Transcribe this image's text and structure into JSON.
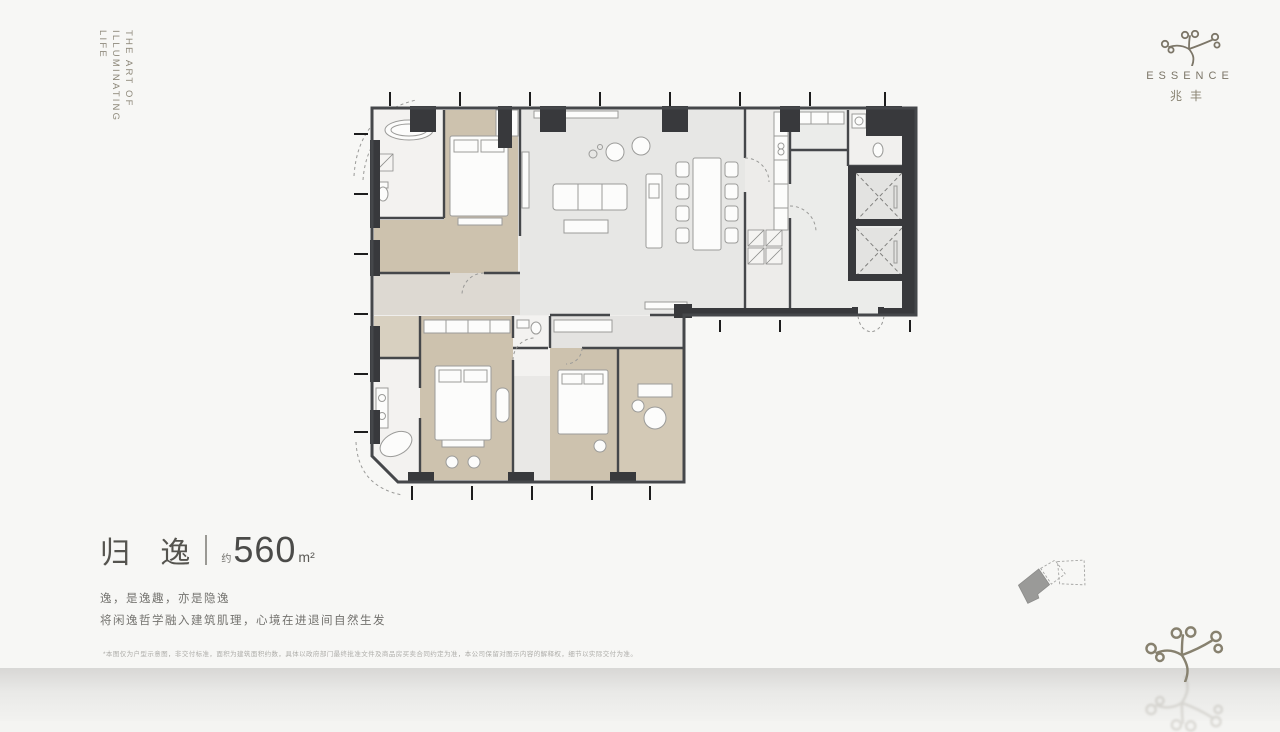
{
  "page": {
    "background": "#f4f4f2",
    "surface_band_top": "#d8d7d5"
  },
  "tagline": {
    "lines": [
      "THE ART OF",
      "ILLUMINATING",
      "LIFE"
    ]
  },
  "logo": {
    "wordmark": "ESSENCE",
    "cn": "兆丰",
    "icon": "branch-sprout-icon",
    "color": "#7c7668"
  },
  "floorplan": {
    "description": "L-shaped luxury apartment floor plan",
    "colors": {
      "wall": "#45474a",
      "column": "#38393c",
      "bedroom_floor": "#cdc2ae",
      "living_floor": "#e7e7e5",
      "bath_floor": "#f3f2f0"
    }
  },
  "title": {
    "name_cn": "归 逸",
    "approx": "约",
    "area_value": "560",
    "area_unit": "m²"
  },
  "copy": {
    "line1": "逸，是逸趣，亦是隐逸",
    "line2": "将闲逸哲学融入建筑肌理，心境在进退间自然生发"
  },
  "disclaimer": "*本图仅为户型示意图，非交付标准，面积为建筑面积约数，具体以政府部门最终批准文件及商品房买卖合同约定为准，本公司保留对图示内容的解释权，细节以实际交付为准。",
  "keyplan": {
    "description": "building key plan, highlighted unit at left",
    "highlight_color": "#9a9a98"
  }
}
